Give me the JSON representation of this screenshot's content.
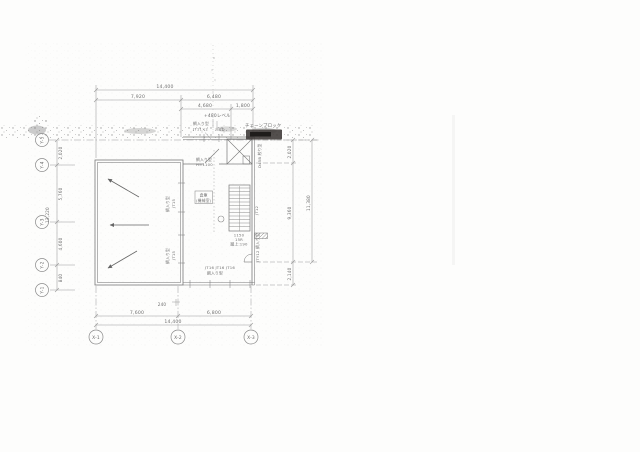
{
  "drawing": {
    "kind": "scanned architectural floor plan",
    "paper_color": "#fdfdfc",
    "line_color": "#8a8a8a",
    "wall_color": "#787878",
    "text_color": "#6f6f6f",
    "stamp_color": "#332f2c"
  },
  "dims": {
    "top": {
      "overall": "14,400",
      "seg_left": "7,920",
      "seg_right": "6,480",
      "sub_left": "4,680",
      "sub_right": "1,800"
    },
    "bottom": {
      "seg_left": "7,600",
      "seg_right": "6,800",
      "overall": "14,400",
      "offset_note": "240"
    },
    "left": {
      "seg1": "2,020",
      "seg2": "5,760",
      "seg3": "4,600",
      "seg4": "840",
      "overall": "13,220"
    },
    "right": {
      "seg1": "2,020",
      "seg2": "9,360",
      "seg3": "2,140",
      "overall": "11,380"
    }
  },
  "grid": {
    "x": [
      "X-1",
      "X-2",
      "X-3"
    ],
    "y": [
      "Y-5",
      "Y-4",
      "Y-3",
      "Y-2",
      "Y-1"
    ]
  },
  "rooms": {
    "storage_line1": "倉庫",
    "storage_line2": "(機械室)"
  },
  "stair": {
    "width": "1150",
    "risers": "15R",
    "riser_note": "蹴上:190"
  },
  "labels": {
    "level": "+480レベル",
    "sash_top_1": "網入り型",
    "sash_top_2": "JT11×2",
    "sash_top_3": "SD",
    "chain_block": "チェーンブロック",
    "rail_1": "網入り型",
    "rail_2": "H=1100",
    "sash_right_1": "D45B 絞り型",
    "sash_right_2": "JT12",
    "sash_right_3": "JTY12 網入り型",
    "sash_left_a1": "網入り型",
    "sash_left_a2": "JT15",
    "sash_left_b1": "網入り型",
    "sash_left_b2": "JT15",
    "sash_bottom_1": "JT16  JT16  JT16",
    "sash_bottom_2": "網入り型"
  }
}
